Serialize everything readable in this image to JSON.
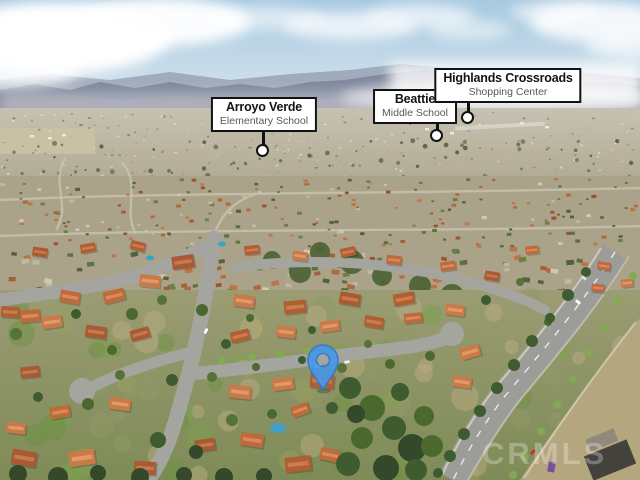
{
  "callouts": [
    {
      "title": "Arroyo Verde",
      "subtitle": "Elementary School"
    },
    {
      "title": "Beattie",
      "subtitle": "Middle School"
    },
    {
      "title": "Highlands Crossroads",
      "subtitle": "Shopping Center"
    }
  ],
  "callout_style": {
    "border_color": "#121212",
    "background": "#ffffff"
  },
  "map_pin": {
    "color": "#4598e9",
    "stroke": "#2d79cf"
  },
  "watermark": {
    "text": "CRMLS",
    "color": "#ffffff"
  }
}
